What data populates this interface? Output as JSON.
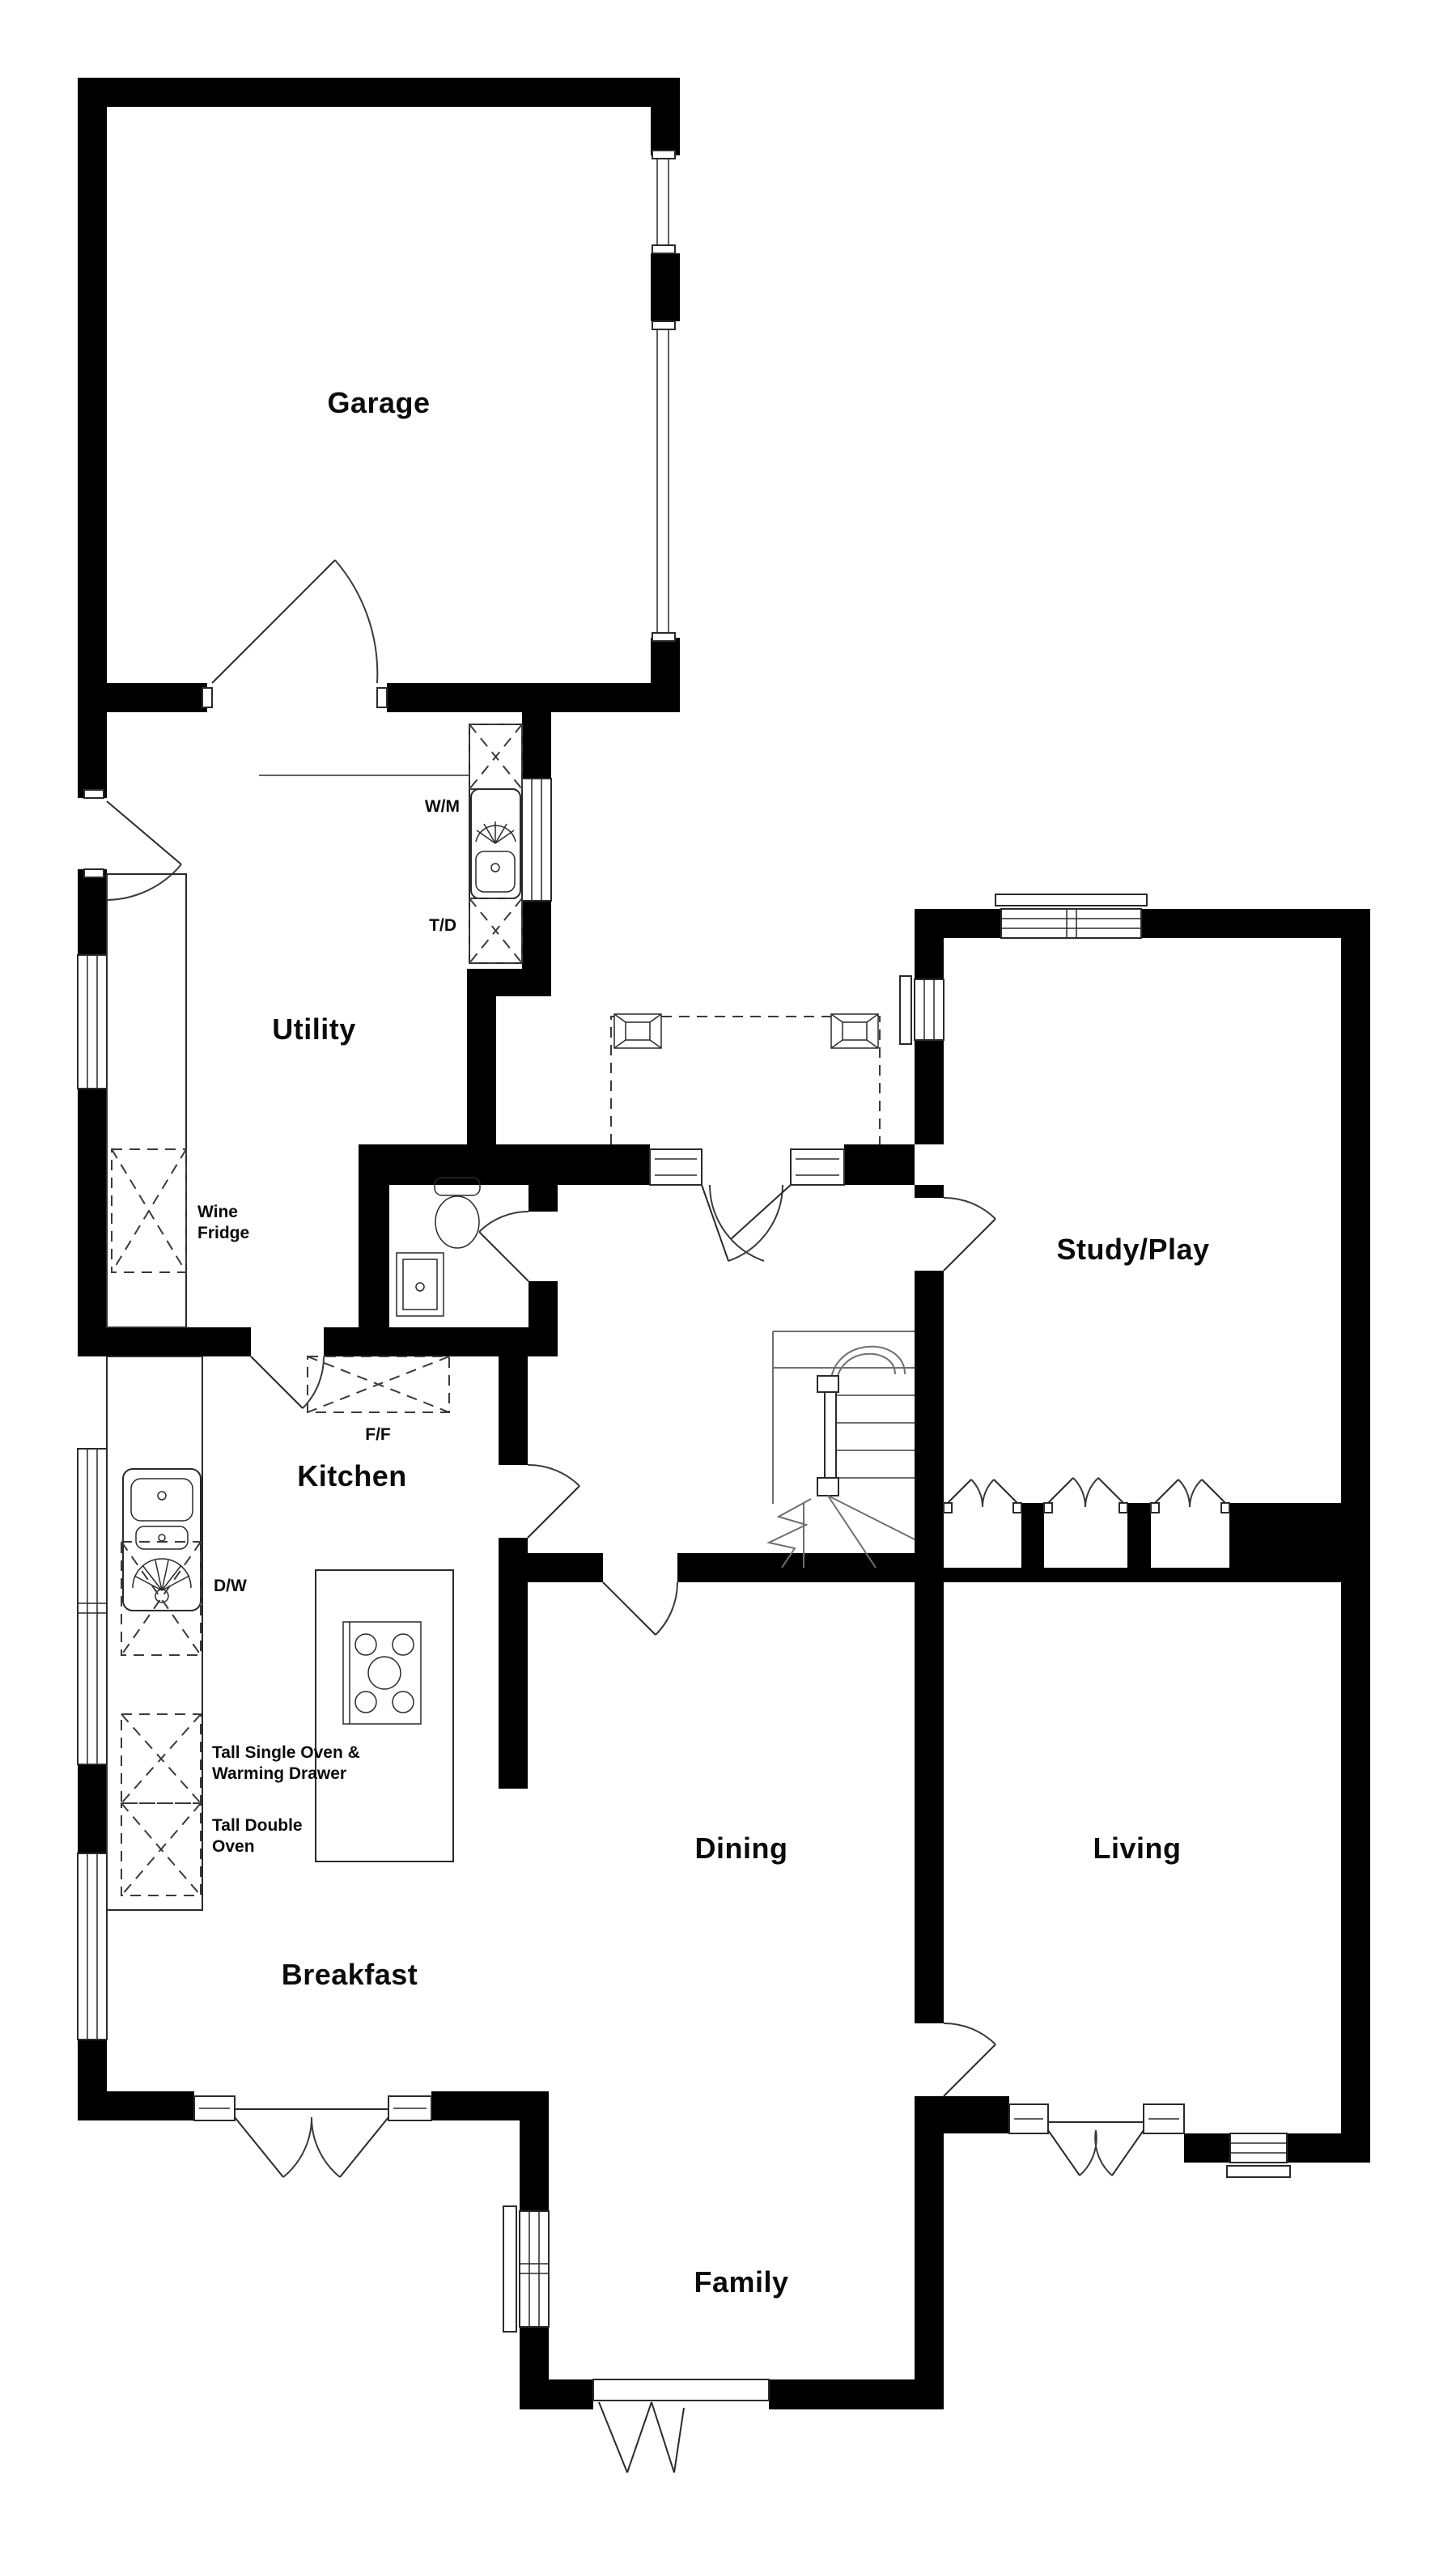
{
  "plan": {
    "type": "ground-floor-plan",
    "colors": {
      "wall": "#000000",
      "line": "#2a2a2a",
      "soft_line": "#6f6f6f",
      "background": "#ffffff"
    },
    "rooms": {
      "garage": {
        "label": "Garage"
      },
      "utility": {
        "label": "Utility"
      },
      "study": {
        "label": "Study/Play"
      },
      "kitchen": {
        "label": "Kitchen"
      },
      "dining": {
        "label": "Dining"
      },
      "living": {
        "label": "Living"
      },
      "breakfast": {
        "label": "Breakfast"
      },
      "family": {
        "label": "Family"
      }
    },
    "appliances": {
      "wm": {
        "label": "W/M"
      },
      "td": {
        "label": "T/D"
      },
      "wine_line1": "Wine",
      "wine_line2": "Fridge",
      "ff": {
        "label": "F/F"
      },
      "dw": {
        "label": "D/W"
      },
      "tall_single_line1": "Tall Single Oven &",
      "tall_single_line2": "Warming Drawer",
      "tall_double_line1": "Tall Double",
      "tall_double_line2": "Oven"
    }
  }
}
